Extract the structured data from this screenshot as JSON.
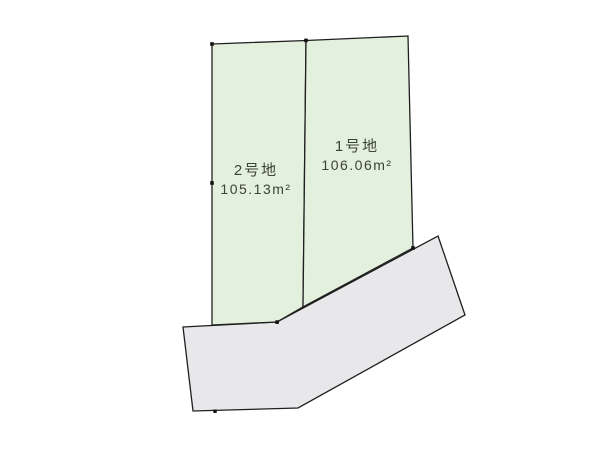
{
  "diagram": {
    "kind": "land-plot-layout",
    "plots": [
      {
        "name": "1号地",
        "area": "106.06m²"
      },
      {
        "name": "2号地",
        "area": "105.13m²"
      }
    ]
  },
  "colors": {
    "plot_fill": "#e4f0de",
    "road_fill": "#e8e8ea",
    "line": "#1f1f1f",
    "text": "#3c4237",
    "background": "#ffffff"
  }
}
